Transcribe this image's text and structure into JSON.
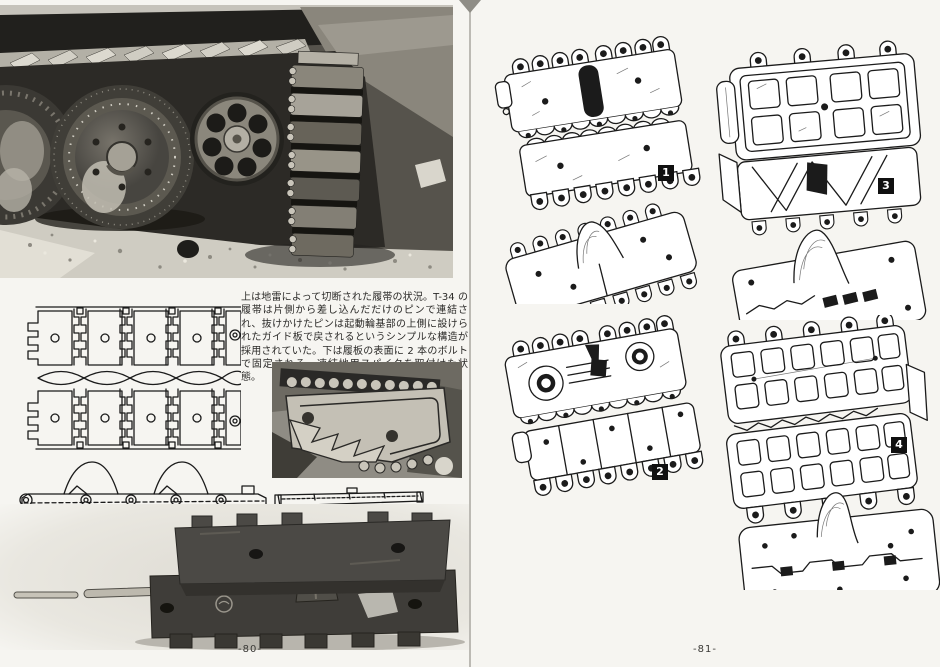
{
  "document": {
    "kind": "scanned book spread",
    "language": "ja",
    "subject": "T-34 履帯 (track links)"
  },
  "colors": {
    "page_background": "#f6f5f1",
    "ink": "#1b1b1b",
    "photo_dark": "#23221e",
    "photo_light": "#d8d5cc",
    "figure_label_background": "#101010",
    "figure_label_text": "#ffffff",
    "gutter_line": "#9b9992"
  },
  "left_page": {
    "page_number": "-80-",
    "caption": "上は地雷によって切断された履帯の状況。T-34 の履帯は片側から差し込んだだけのピンで連結され、抜けかけたピンは起動輪基部の上側に設けられたガイド板で戻されるというシンプルな構造が採用されていた。下は履板の表面に 2 本のボルトで固定される、凍結地用スパイクを取付けた状態。"
  },
  "right_page": {
    "page_number": "-81-",
    "figures": [
      {
        "label": "1",
        "caption": "1：A-34 試作車に用いられていた型打ち製造による履帯。BT シリーズと同様の製造方法で造られている。幅 550 ㎜。"
      },
      {
        "label": "2",
        "caption": "2：1940 年秋の生産型から使用された幅 550 ㎜の鋳造製履帯。雪上など悪路での踏破性能を向上させるため、接地面にリブが追加された。また、凍結路面でのスリップ防止用のスパイクも取付けられるようになった。1943 年頃まで、戦時用での使用が見られる。"
      },
      {
        "label": "3",
        "caption": "3：T-34M 用に開発された履帯を拡張した 500 ㎜幅の鋳造履帯。いわゆる“ワッフル・パターン”のさきがけとなるもので、1941 年後半から 1942 年にかけて製造された車体（第 183 向上やスターリングラード 製の車体で使用されている例が見られる。"
      },
      {
        "label": "4",
        "caption": "4：ワッフル・パターンの接地面を持つ 500 ㎜幅の鋳造履帯にもパターンに何種類ものバリエーションがある。図のタイプは 1942 年後半から見られ始めるようになったタイプで、戦後まで各種のパターンが存在する。"
      }
    ]
  }
}
